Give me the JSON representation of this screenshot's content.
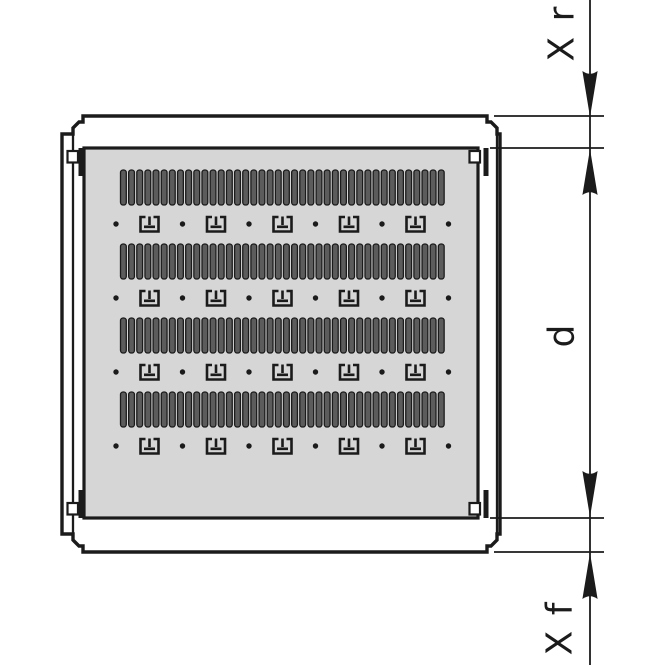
{
  "figure": {
    "kind": "technical-drawing",
    "subject": "rack-shelf-top-view-with-depth-dimensions",
    "labels": {
      "rear": "X r",
      "depth": "d",
      "front": "X f"
    },
    "colors": {
      "background": "#ffffff",
      "line": "#1b1b1b",
      "panel_fill": "#d6d6d6",
      "slot_fill": "#5c5c5c"
    },
    "perforation": {
      "slot_rows_y": [
        170,
        244,
        318,
        392
      ],
      "slots_per_row": 40,
      "slot_width": 5.8,
      "slot_height": 35,
      "slot_pitch": 8.15,
      "slot_start_x": 120.5,
      "clip_rows_cy": [
        224,
        298,
        372,
        446
      ],
      "clips_per_row": 5,
      "clip_start_cx": 149.5,
      "clip_pitch": 66.5,
      "dots_per_row": 6,
      "dot_start_cx": 116,
      "dot_pitch": 66.5,
      "dot_radius": 2.7
    }
  }
}
